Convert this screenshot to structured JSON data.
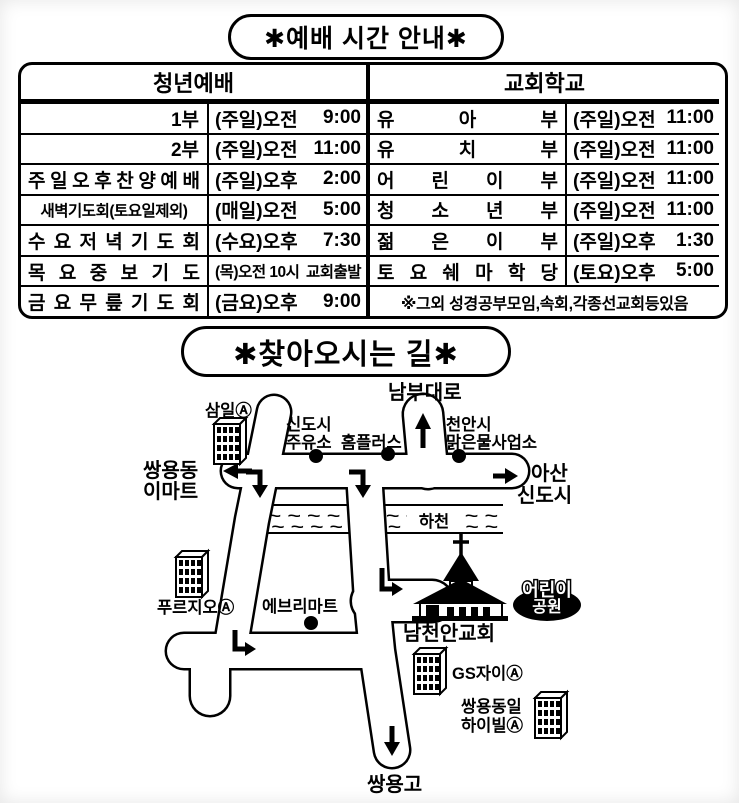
{
  "schedule": {
    "title": "✱예배 시간 안내✱",
    "header_left": "청년예배",
    "header_right": "교회학교",
    "left_rows": [
      {
        "label": "1부",
        "day": "(주일)오전",
        "time": "9:00"
      },
      {
        "label": "2부",
        "day": "(주일)오전",
        "time": "11:00"
      },
      {
        "label": "주일오후찬양예배",
        "day": "(주일)오후",
        "time": "2:00"
      },
      {
        "label": "새벽기도회(토요일제외)",
        "day": "(매일)오전",
        "time": "5:00"
      },
      {
        "label": "수요저녁기도회",
        "day": "(수요)오후",
        "time": "7:30"
      },
      {
        "label": "목요중보기도",
        "day": "(목)오전 10시",
        "time": "교회출발"
      },
      {
        "label": "금요무릎기도회",
        "day": "(금요)오후",
        "time": "9:00"
      }
    ],
    "right_rows": [
      {
        "label": "유아부",
        "day": "(주일)오전",
        "time": "11:00"
      },
      {
        "label": "유치부",
        "day": "(주일)오전",
        "time": "11:00"
      },
      {
        "label": "어린이부",
        "day": "(주일)오전",
        "time": "11:00"
      },
      {
        "label": "청소년부",
        "day": "(주일)오전",
        "time": "11:00"
      },
      {
        "label": "젊은이부",
        "day": "(주일)오후",
        "time": "1:30"
      },
      {
        "label": "토요쉐마학당",
        "day": "(토요)오후",
        "time": "5:00"
      }
    ],
    "note": "※그외 성경공부모임,속회,각종선교회등있음"
  },
  "directions": {
    "title": "✱찾아오시는 길✱",
    "labels": {
      "nambu_daero": "남부대로",
      "samil": "삼일Ⓐ",
      "sindosi_gas1": "신도시",
      "sindosi_gas2": "주유소",
      "homeplus": "홈플러스",
      "cheonan1": "천안시",
      "cheonan2": "맑은물사업소",
      "ssangyongdong1": "쌍용동",
      "ssangyongdong2": "이마트",
      "asan1": "아산",
      "asan2": "신도시",
      "stream": "하천",
      "waves": "~ ~ ~ ~ ~ ~ ~ ~ ~ ~ ~ ~ ~",
      "prugio": "푸르지오Ⓐ",
      "everymart": "에브리마트",
      "church": "남천안교회",
      "children1": "어린이",
      "children2": "공원",
      "gs_xi": "GS자이Ⓐ",
      "haivill1": "쌍용동일",
      "haivill2": "하이빌Ⓐ",
      "ssangyong_high": "쌍용고"
    }
  },
  "colors": {
    "ink": "#000000",
    "paper": "#ffffff"
  }
}
